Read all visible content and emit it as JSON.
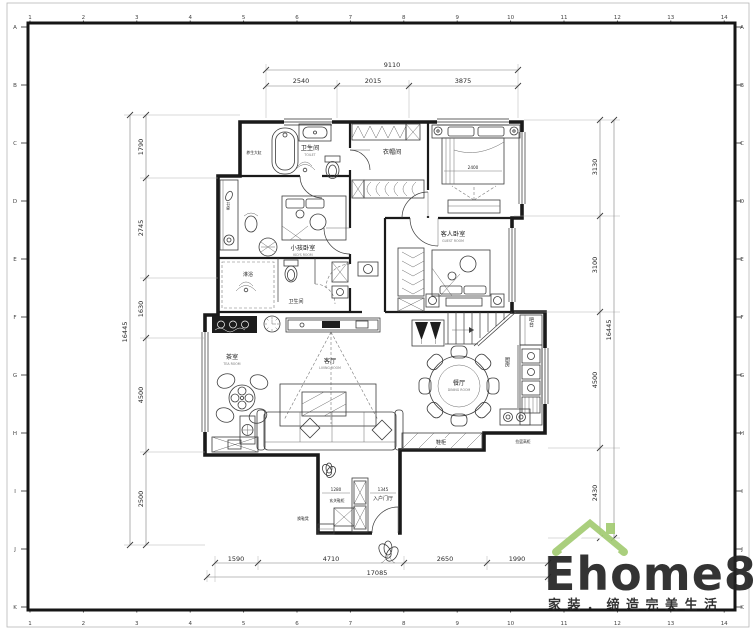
{
  "sheet": {
    "background": "#ffffff",
    "frame_color": "#151515"
  },
  "grid": {
    "columns": [
      "1",
      "2",
      "3",
      "4",
      "5",
      "6",
      "7",
      "8",
      "9",
      "10",
      "11",
      "12",
      "13",
      "14"
    ],
    "rows": [
      "A",
      "B",
      "C",
      "D",
      "E",
      "F",
      "G",
      "H",
      "I",
      "J",
      "K"
    ]
  },
  "dims": {
    "top": {
      "overall": "9110",
      "segments": [
        "2540",
        "2015",
        "3875"
      ]
    },
    "bottom": {
      "overall": "17085",
      "segments": [
        "1590",
        "4710",
        "2650",
        "1990"
      ]
    },
    "left": {
      "overall": "16445",
      "segments": [
        "1790",
        "2745",
        "1630",
        "4500",
        "2500"
      ]
    },
    "right": {
      "overall": "16445",
      "segments": [
        "3130",
        "3100",
        "4500",
        "2430"
      ]
    }
  },
  "rooms": {
    "bath_top": {
      "label": "卫生间",
      "en": "TOILET"
    },
    "cloakroom": {
      "label": "衣帽间"
    },
    "kids": {
      "label": "小孩卧室",
      "en": "KID'S ROOM"
    },
    "guest": {
      "label": "客人卧室",
      "en": "GUEST ROOM"
    },
    "shower": {
      "label": "淋浴"
    },
    "bath_mid": {
      "label": "卫生间"
    },
    "tea": {
      "label": "茶室",
      "en": "TEA ROOM"
    },
    "living": {
      "label": "客厅",
      "en": "LIVING ROOM"
    },
    "dining": {
      "label": "餐厅",
      "en": "DINING ROOM"
    },
    "kitchen": {
      "label": "厨房"
    },
    "bar": {
      "label": "吧台"
    },
    "entry": {
      "label": "入户门厅"
    }
  },
  "annotations": {
    "desk": "书桌",
    "health_tub": "养生大缸",
    "shoe_cabinet": "鞋柜",
    "entry_cabinet": "玄关鞋柜",
    "shoe_bench": "换鞋凳",
    "tall_cabinet": "拉篮高柜",
    "bed_width": "2400",
    "entry_width_left": "1280",
    "entry_width_right": "1345"
  },
  "logo": {
    "brand": "Ehome8",
    "tagline": "家装．缔造完美生活",
    "brand_color": "#f8cda6",
    "tagline_color": "#cbe0a7",
    "icon_color": "#a3cc72",
    "icon": "house-roof-icon"
  }
}
